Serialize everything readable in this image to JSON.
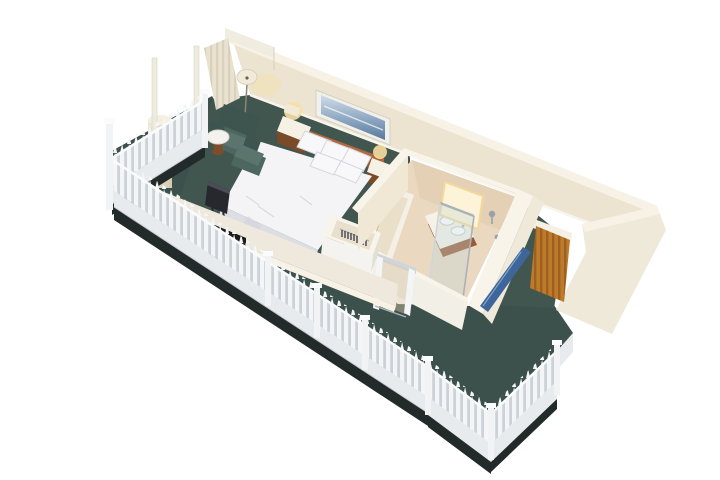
{
  "meta": {
    "kind": "isometric-3d-floorplan",
    "subject": "hotel guest room with bedroom, bathroom, wardrobe, entry and wraparound balcony with white picket railing"
  },
  "objects": [
    "back-wall",
    "curtain-panel",
    "wall-artwork",
    "floor-lamp",
    "armchair",
    "ottoman",
    "side-table",
    "king-bed",
    "pillows",
    "headboard",
    "nightstand-left",
    "nightstand-right",
    "table-lamps",
    "tv",
    "minibar-credenza",
    "teal-carpet",
    "wardrobe-with-hangers",
    "bathroom",
    "bathtub",
    "vanity-double-sink",
    "lit-mirror",
    "glass-shower",
    "shower-fixtures",
    "blue-slot-window",
    "sliding-glass-door",
    "entry-wood-door",
    "balcony-column",
    "slim-posts",
    "picket-fence",
    "balcony-floor"
  ],
  "palette": {
    "bg": "#ffffff",
    "wallFace": "#ece3d0",
    "wallFaceDark": "#e2d7c0",
    "wallTop": "#f7f2e5",
    "wallCap": "#f1ece0",
    "rightWall": "#efe9d9",
    "baseboard": "#f8f5ec",
    "curtain": "#e9e2d1",
    "curtainStripe": "#d8cfb8",
    "carpet": "#40564f",
    "balconyFloor": "#3c514b",
    "slabEdge": "#232a2a",
    "woodDoor": "#bd7a2b",
    "woodGrainDark": "#8a5418",
    "doorLintel": "#f4f0e4",
    "fencePicket": "#f3f5f7",
    "fenceGap": "#ccd2d8",
    "fenceLower": "#e8ebee",
    "fenceRail": "#fafbfd",
    "fencePost": "#f1f3f5",
    "fenceEdge": "#c7cdd3",
    "bedWhite": "#f4f4f6",
    "bedSide": "#dddee4",
    "bedShadow": "#d2d3da",
    "pillow": "#f8f8fb",
    "pillowEdge": "#d6d7de",
    "headboard": "#94552f",
    "headboardTop": "#b06a3c",
    "nightstandTop": "#f6f1e4",
    "nightstandWood": "#7b4a28",
    "lampGlow": "#f7df9e",
    "lampShade": "#f1ead9",
    "lampStem": "#8a8778",
    "artFrame": "#f2f0ea",
    "artFrameEdge": "#d4d0c4",
    "artBlueTop": "#cfdde9",
    "artBlueBottom": "#57799e",
    "chairTeal": "#4c6760",
    "chairTealDark": "#3d554e",
    "chairTealLight": "#5b756d",
    "tableTop": "#f3f2ee",
    "tableTopEdge": "#d8d5ca",
    "tableBase": "#7d4e2c",
    "tvDark": "#26282d",
    "tvLight": "#4a4d55",
    "parapetFace": "#eee9dc",
    "minibarRecess": "#2e2a24",
    "minibarLip": "#1c1b18",
    "minibarWood": "#8a5328",
    "bathFloor": "#ead9c0",
    "bathFloorShadow": "#dcc8a9",
    "bathWallFace": "#f0e7d4",
    "bathWallTop": "#f8f4ea",
    "bathFrontWall": "#f2efe6",
    "tubRim": "#f4f0e5",
    "tubInner": "#eadfc9",
    "vanityWood": "#9a5a33",
    "counter": "#f6f2e8",
    "sinkWhite": "#ffffff",
    "sinkEdge": "#cfc9ba",
    "mirrorLit": "#fdf3d8",
    "mirrorGlow": "#f2d89a",
    "chrome": "#aab2b9",
    "chromeLight": "#cfd6db",
    "glass": "rgba(196,214,218,0.35)",
    "glassDoor": "rgba(214,196,164,0.45)",
    "windowBlue": "#3f669b",
    "windowBlueLight": "#7fa3c6",
    "wardrobeInner": "#e8e0cc",
    "wardrobeFront": "#f4f3ef",
    "wardrobeSide": "#e2dfd4",
    "hanger": "#43464c",
    "column": "#efe8d6",
    "columnShade": "#d5c9ae",
    "columnTop": "#f5efdf",
    "postSlim": "#eeebdf",
    "postSlimEdge": "#d8d2c4"
  }
}
